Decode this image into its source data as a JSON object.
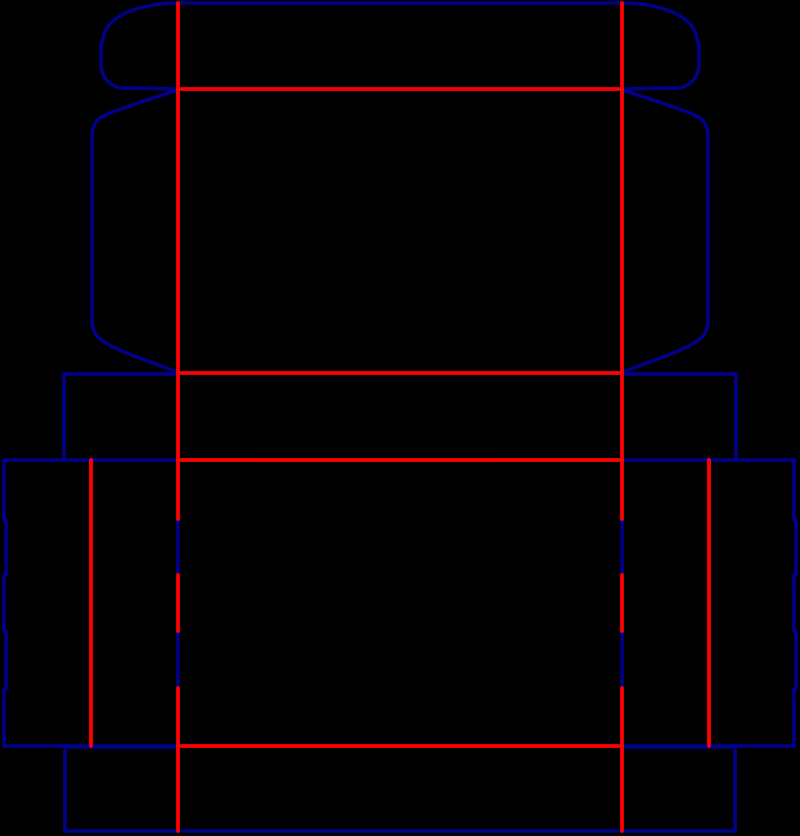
{
  "canvas": {
    "width": 800,
    "height": 836,
    "background": "#000000"
  },
  "palette": {
    "cut_color": "#00008B",
    "crease_color": "#FF0000"
  },
  "strokes": {
    "cut_width": 3.5,
    "crease_width": 3.8
  },
  "cut_paths": [
    "M177 3 L623 3",
    "M177 3 C140 4 112 14 105 32 C102 40 101 47 101 54 L101 63 C101 76 107 84 119 88 L177 89",
    "M623 3 C660 4 688 14 695 32 C698 40 699 47 699 54 L699 63 C699 76 693 84 681 88 L623 89",
    "M177 90 C146 101 113 110 100 118 C94 122 92 129 92 138 L92 318 C92 328 94 334 100 339 C114 350 148 361 177 372",
    "M623 90 C654 101 687 110 700 118 C706 122 708 129 708 138 L708 318 C708 328 706 334 700 339 C686 350 652 361 623 372",
    "M178 374 L64 374 L64 459",
    "M622 374 L736 374 L736 459",
    "M4 460 L178 460",
    "M622 460 L795 460",
    "M4 460 L4 520 L6 520 L6 575 L4 575 L4 631 L6 631 L6 689 L4 689 L4 746",
    "M794 460 L794 520 L796 520 L796 575 L794 575 L794 631 L796 631 L796 689 L794 689 L794 746",
    "M4 746 L178 746",
    "M622 746 L794 746",
    "M178 519 L178 575",
    "M178 631 L178 688",
    "M622 519 L622 575",
    "M622 631 L622 688",
    "M178 747 L65 747 L65 831 L735 831 L735 747 L622 747"
  ],
  "crease_paths": [
    "M178 3 L178 519",
    "M178 575 L178 631",
    "M178 688 L178 831",
    "M622 3 L622 519",
    "M622 575 L622 631",
    "M622 688 L622 831",
    "M178 89 L622 89",
    "M178 373 L622 373",
    "M178 460 L622 460",
    "M178 746 L622 746",
    "M91 460 L91 746",
    "M709 460 L709 746"
  ]
}
